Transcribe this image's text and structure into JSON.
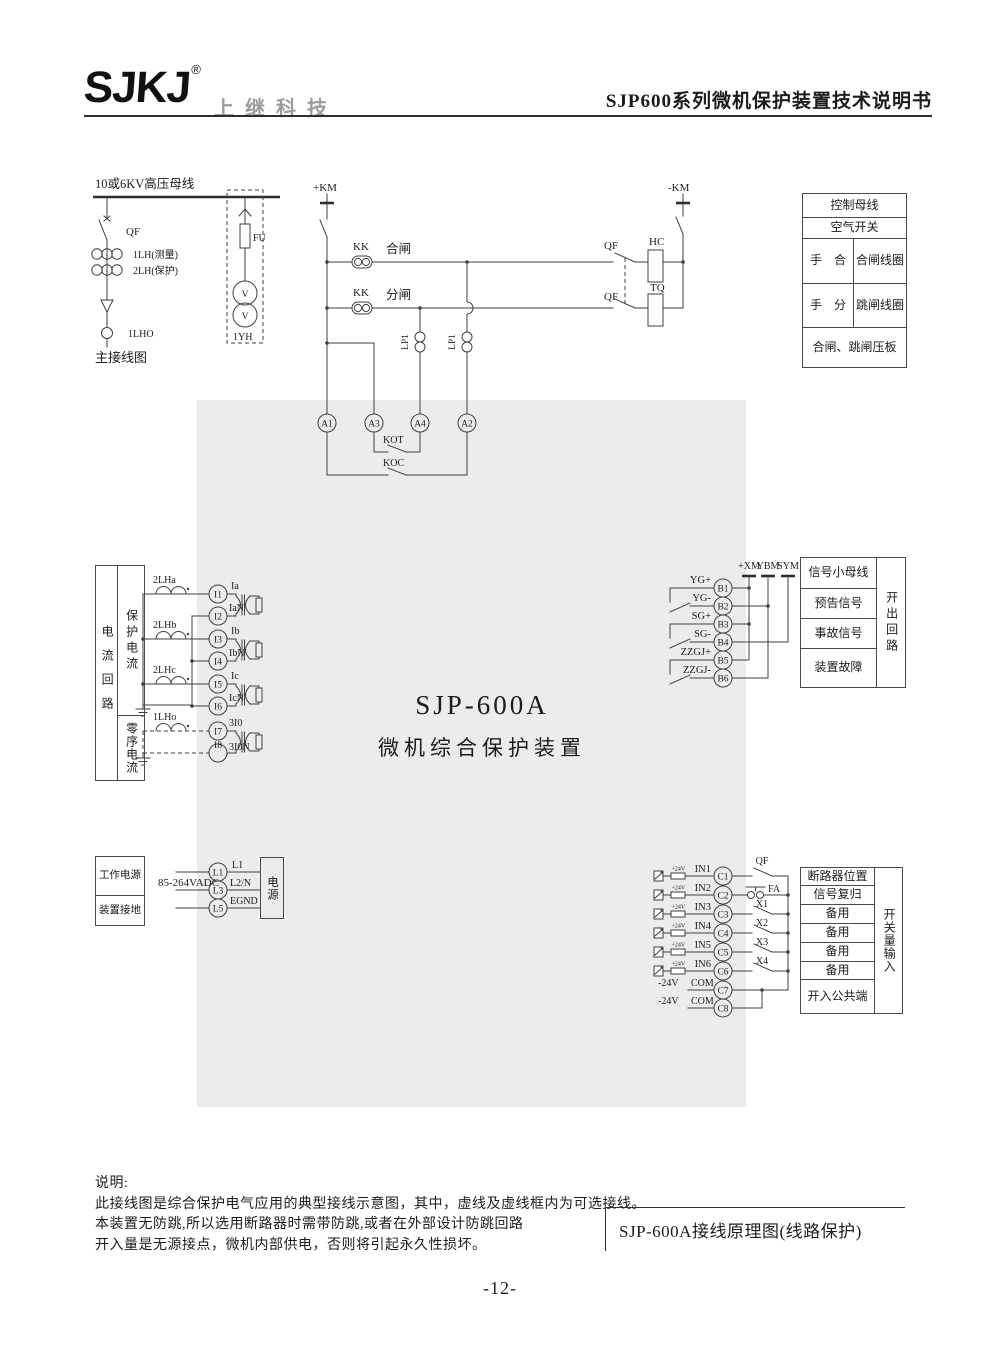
{
  "header": {
    "logo": "SJKJ",
    "logo_reg": "®",
    "brand": "上继科技",
    "doc_title": "SJP600系列微机保护装置技术说明书"
  },
  "device": {
    "model": "SJP-600A",
    "name": "微机综合保护装置"
  },
  "main_circuit": {
    "bus": "10或6KV高压母线",
    "qf": "QF",
    "ct_measure": "1LH(测量)",
    "ct_protect": "2LH(保护)",
    "ct_zero": "1LHO",
    "caption": "主接线图",
    "fuse": "FU",
    "vt": "1YH",
    "v": "V"
  },
  "control_circuit": {
    "km_plus": "+KM",
    "km_minus": "-KM",
    "kk": "KK",
    "close": "合闸",
    "open": "分闸",
    "lp1": "LP1",
    "qf": "QF",
    "hc": "HC",
    "tq": "TQ",
    "a1": "A1",
    "a2": "A2",
    "a3": "A3",
    "a4": "A4",
    "kot": "KOT",
    "koc": "KOC"
  },
  "control_table": {
    "r1": "控制母线",
    "r2": "空气开关",
    "r3_left": "手　合",
    "r3_right": "合闸线圈",
    "r4_left": "手　分",
    "r4_right": "跳闸线圈",
    "r5": "合闸、跳闸压板"
  },
  "current_circuit": {
    "table": {
      "left": "电流回路",
      "top": "保护电流",
      "bottom": "零序电流"
    },
    "ct_a": "2LHa",
    "ct_b": "2LHb",
    "ct_c": "2LHc",
    "ct_0": "1LHo",
    "t": {
      "i1": "I1",
      "i2": "I2",
      "i3": "I3",
      "i4": "I4",
      "i5": "I5",
      "i6": "I6",
      "i7": "I7",
      "i8": "I8"
    },
    "sig": {
      "ia": "Ia",
      "ian": "IaN",
      "ib": "Ib",
      "ibn": "IbN",
      "ic": "Ic",
      "icn": "IcN",
      "i30": "3I0",
      "i30n": "3I0N"
    }
  },
  "signal_circuit": {
    "yg_plus": "YG+",
    "yg_minus": "YG-",
    "sg_plus": "SG+",
    "sg_minus": "SG-",
    "zzgj_plus": "ZZGJ+",
    "zzgj_minus": "ZZGJ-",
    "b1": "B1",
    "b2": "B2",
    "b3": "B3",
    "b4": "B4",
    "b5": "B5",
    "b6": "B6",
    "xm": "+XM",
    "ybm": "YBM",
    "sym": "SYM"
  },
  "signal_table": {
    "r1": "信号小母线",
    "r2": "预告信号",
    "r3": "事故信号",
    "r4": "装置故障",
    "side": "开出回路"
  },
  "power_circuit": {
    "table": {
      "r1": "工作电源",
      "r2": "装置接地"
    },
    "voltage": "85-264VADC",
    "l1": "L1",
    "l3": "L3",
    "l5": "L5",
    "l1_sig": "L1",
    "l2_sig": "L2/N",
    "l5_sig": "EGND",
    "box": "电源"
  },
  "input_circuit": {
    "in1": "IN1",
    "in2": "IN2",
    "in3": "IN3",
    "in4": "IN4",
    "in5": "IN5",
    "in6": "IN6",
    "v24": "+24V",
    "c1": "C1",
    "c2": "C2",
    "c3": "C3",
    "c4": "C4",
    "c5": "C5",
    "c6": "C6",
    "c7": "C7",
    "c8": "C8",
    "qf": "QF",
    "fa": "FA",
    "x1": "X1",
    "x2": "X2",
    "x3": "X3",
    "x4": "X4",
    "minus24": "-24V",
    "com": "COM"
  },
  "input_table": {
    "r1": "断路器位置",
    "r2": "信号复归",
    "r3": "备用",
    "r4": "备用",
    "r5": "备用",
    "r6": "备用",
    "r7": "开入公共端",
    "side": "开关量输入"
  },
  "notes": {
    "title": "说明:",
    "line1": "此接线图是综合保护电气应用的典型接线示意图，其中，虚线及虚线框内为可选接线。",
    "line2": "本装置无防跳,所以选用断路器时需带防跳,或者在外部设计防跳回路",
    "line3": "开入量是无源接点，微机内部供电，否则将引起永久性损坏。"
  },
  "caption": "SJP-600A接线原理图(线路保护)",
  "page_number": "-12-"
}
